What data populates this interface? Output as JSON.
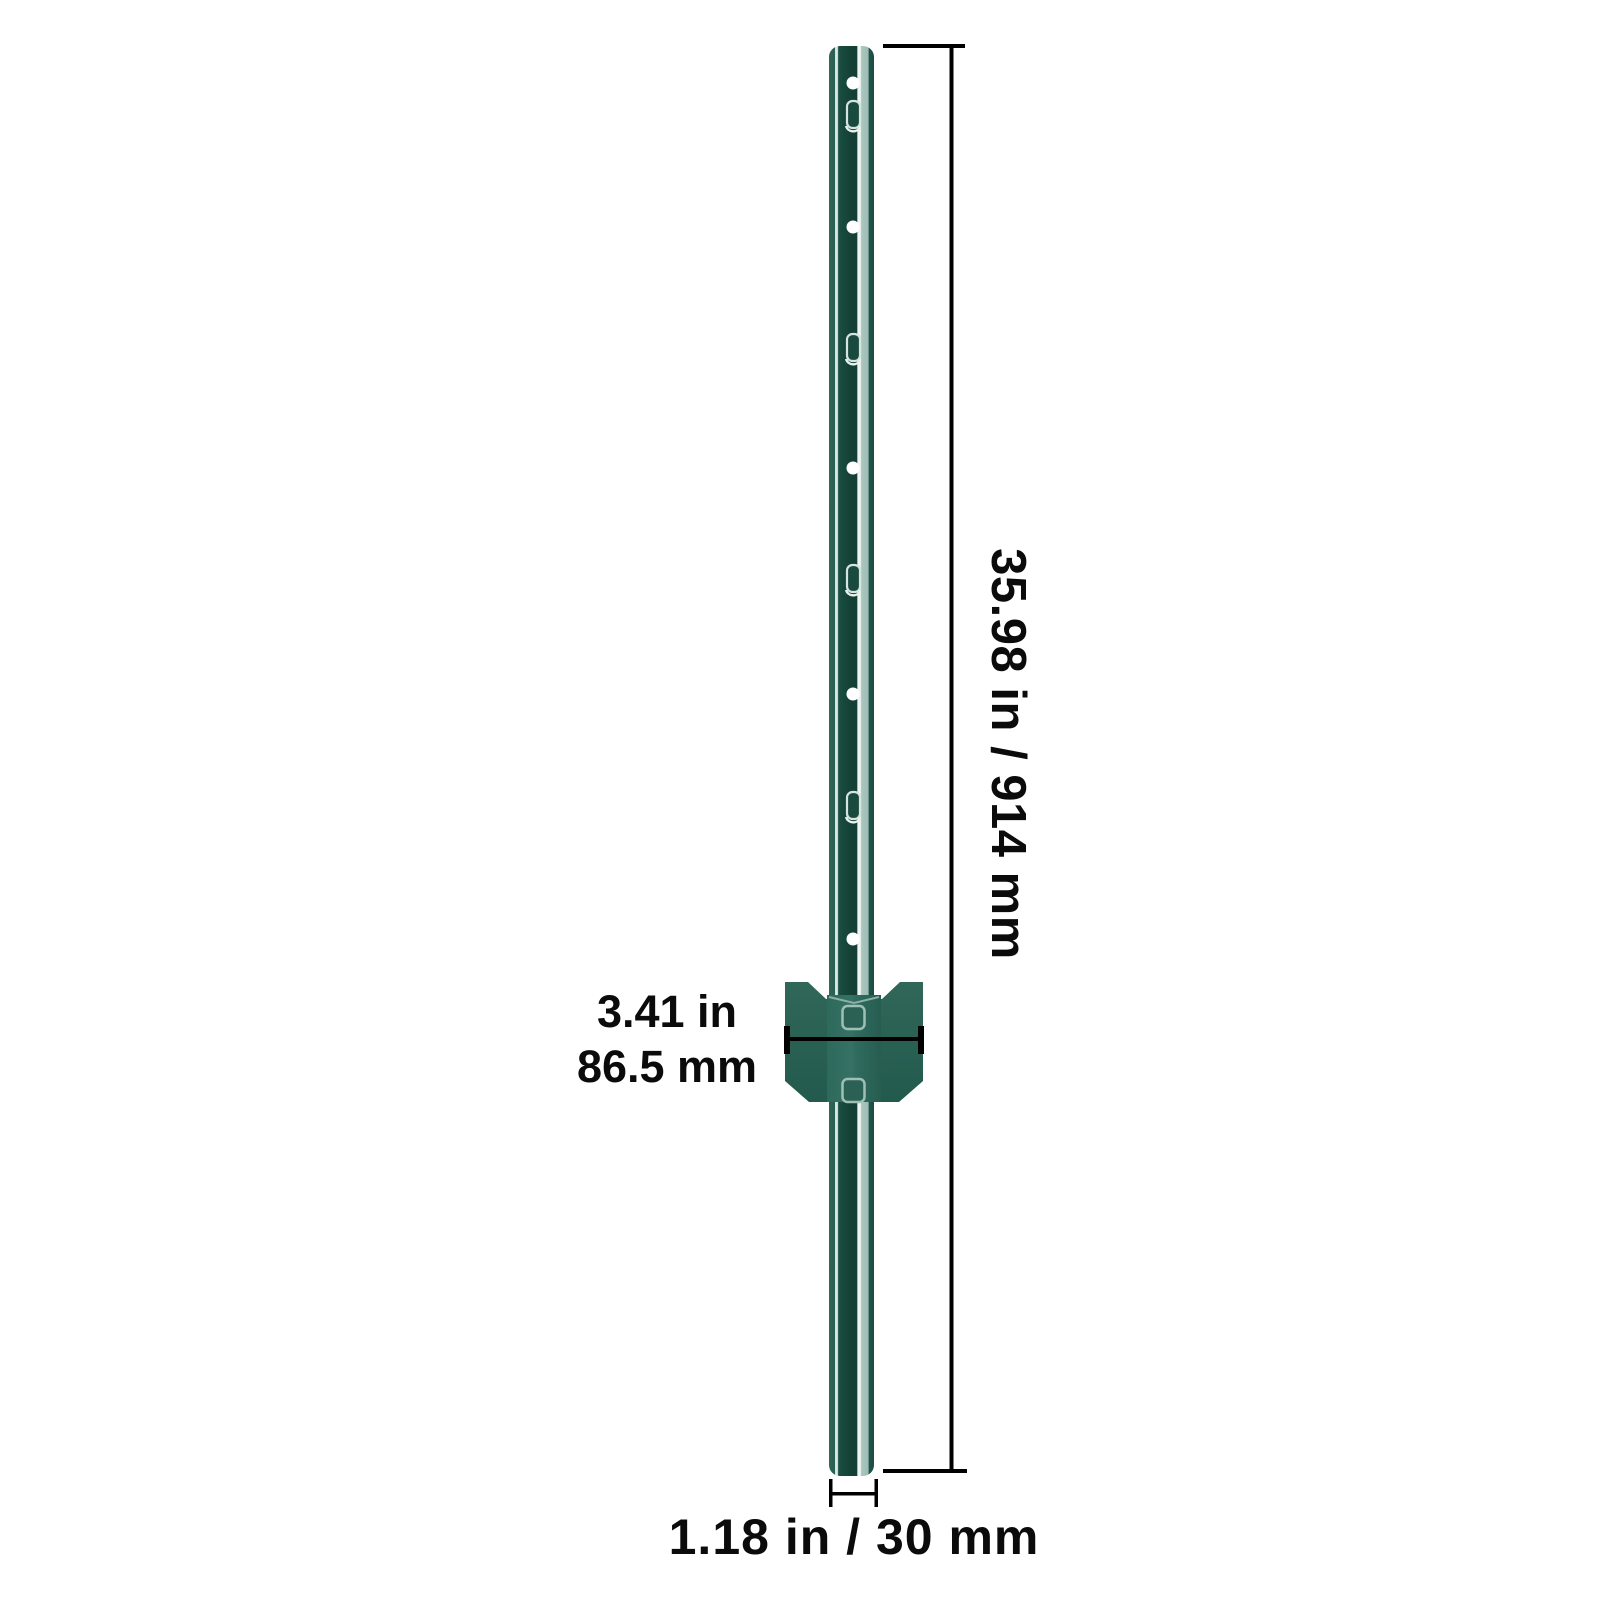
{
  "diagram": {
    "subject": "u-channel-fence-post-with-anchor-plate",
    "background": "#ffffff",
    "dimension_line_color": "#000000",
    "text_color": "#0b0b0b",
    "labels": {
      "height": "35.98 in / 914 mm",
      "plate_width_line1": "3.41 in",
      "plate_width_line2": "86.5 mm",
      "post_width": "1.18 in / 30 mm"
    },
    "post": {
      "color_dark": "#17493d",
      "color_edge": "#2b6054",
      "color_sage_stripe": "#a6c4bb",
      "color_highlight": "#eef4f1",
      "hole_color": "#ffffff",
      "round_holes_y": [
        83,
        227,
        468,
        694,
        939
      ],
      "slot_holes_y": [
        116,
        349,
        580,
        807
      ]
    },
    "anchor_plate": {
      "wing_color": "#2d6559",
      "channel_color": "#316c5e",
      "slot_outline_color": "#9fbfb5",
      "slots_y": [
        1006,
        1079
      ]
    }
  }
}
